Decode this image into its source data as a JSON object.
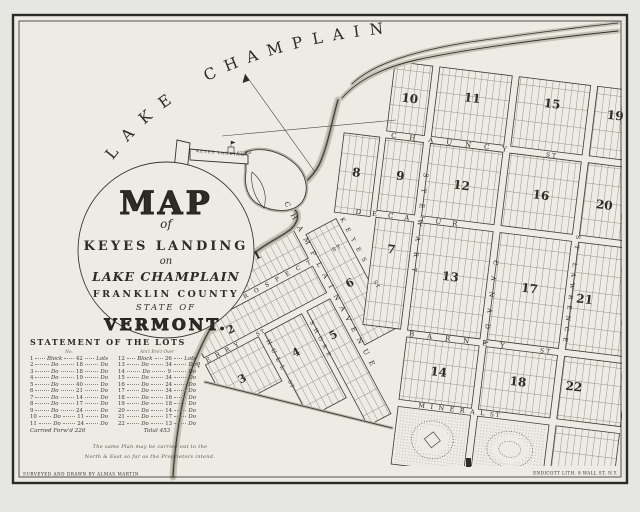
{
  "map": {
    "water": {
      "word1": "LAKE",
      "word2": "CHAMPLAIN"
    },
    "landing_label": "KEYES LANDING",
    "store_label": "STORE",
    "cartouche": {
      "title": "MAP",
      "of": "of",
      "line2": "KEYES LANDING",
      "on": "on",
      "line3": "LAKE CHAMPLAIN",
      "line4": "FRANKLIN COUNTY",
      "line5": "STATE OF",
      "line6": "VERMONT."
    },
    "streets": {
      "chauncy": "CHAUNCY",
      "decatur": "DECATUR",
      "barney": "BARNEY",
      "mineral": "MINERAL",
      "stewart": "STEWART",
      "canada": "CANADA",
      "stlawrence": "ST LAWRENCE",
      "champlain": "CHAMPLAIN",
      "avenue": "AVENUE",
      "prospect": "PROSPECT",
      "keyes": "KEYES",
      "perry": "PERRY",
      "hull": "HULL",
      "shore": "SHORE",
      "st": "ST"
    },
    "blocks": [
      "1",
      "2",
      "3",
      "4",
      "5",
      "6",
      "7",
      "8",
      "9",
      "10",
      "11",
      "12",
      "13",
      "14",
      "15",
      "16",
      "17",
      "18",
      "19",
      "20",
      "21",
      "22"
    ]
  },
  "table": {
    "title": "STATEMENT OF THE LOTS",
    "left_header": "No.",
    "right_header": "Am't Bro't Over",
    "left_rows": [
      [
        "1",
        "Block",
        "42",
        "Lots"
      ],
      [
        "2",
        "Do",
        "18",
        "Do"
      ],
      [
        "3",
        "Do",
        "18",
        "Do"
      ],
      [
        "4",
        "Do",
        "19",
        "Do"
      ],
      [
        "5",
        "Do",
        "40",
        "Do"
      ],
      [
        "6",
        "Do",
        "21",
        "Do"
      ],
      [
        "7",
        "Do",
        "14",
        "Do"
      ],
      [
        "8",
        "Do",
        "17",
        "Do"
      ],
      [
        "9",
        "Do",
        "24",
        "Do"
      ],
      [
        "10",
        "Do",
        "11",
        "Do"
      ],
      [
        "11",
        "Do",
        "24",
        "Do"
      ]
    ],
    "right_rows": [
      [
        "12",
        "Block",
        "26",
        "Lots"
      ],
      [
        "13",
        "Do",
        "34",
        "Do"
      ],
      [
        "14",
        "Do",
        "9",
        "Do"
      ],
      [
        "15",
        "Do",
        "34",
        "Do"
      ],
      [
        "16",
        "Do",
        "24",
        "Do"
      ],
      [
        "17",
        "Do",
        "34",
        "Do"
      ],
      [
        "18",
        "Do",
        "16",
        "Do"
      ],
      [
        "19",
        "Do",
        "18",
        "Do"
      ],
      [
        "20",
        "Do",
        "14",
        "Do"
      ],
      [
        "21",
        "Do",
        "17",
        "Do"
      ],
      [
        "22",
        "Do",
        "13",
        "Do"
      ]
    ],
    "carried": "Carried Forw'd  226",
    "total": "Total  453",
    "note1": "The same Plan may be carried out to the",
    "note2": "North & East so far as the Proprietors intend."
  },
  "credits": {
    "left": "SURVEYED AND DRAWN BY ALMAS MARTIN",
    "right": "ENDICOTT LITH. 8 WALL ST. N.Y."
  },
  "colors": {
    "paper": "#edebe3",
    "ink": "#2e2c26",
    "shade": "#b7b4a8"
  }
}
